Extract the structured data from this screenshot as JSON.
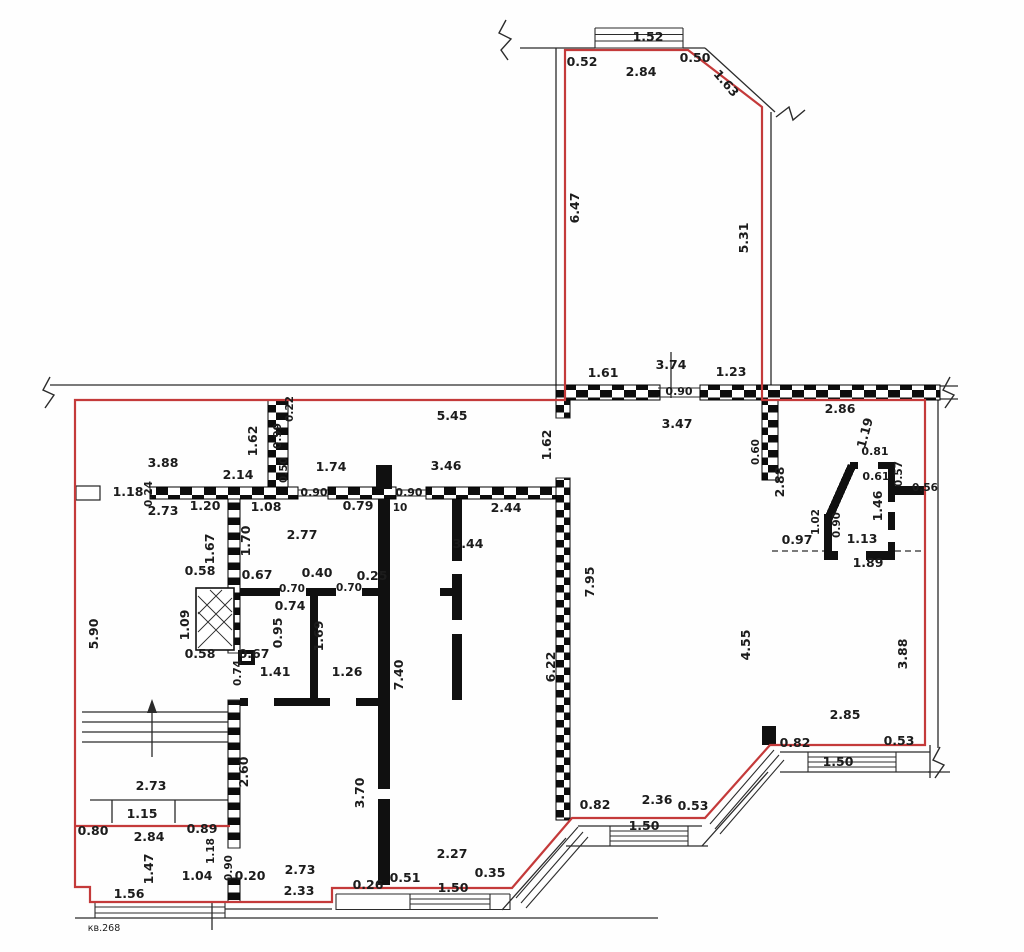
{
  "apartment_label": "кв.268",
  "colors": {
    "boundary": "#c43a3a",
    "wall": "#101010",
    "line": "#2b2b2b"
  },
  "plan": {
    "type": "floor-plan",
    "units": "meters"
  },
  "labels": [
    {
      "t": "1.52",
      "x": 648,
      "y": 41
    },
    {
      "t": "0.52",
      "x": 582,
      "y": 66
    },
    {
      "t": "2.84",
      "x": 641,
      "y": 76
    },
    {
      "t": "0.50",
      "x": 695,
      "y": 62
    },
    {
      "t": "1.63",
      "x": 723,
      "y": 86,
      "r": 49
    },
    {
      "t": "6.47",
      "x": 579,
      "y": 208,
      "r": -90
    },
    {
      "t": "5.31",
      "x": 748,
      "y": 238,
      "r": -90
    },
    {
      "t": "1.61",
      "x": 603,
      "y": 377
    },
    {
      "t": "3.74",
      "x": 671,
      "y": 369
    },
    {
      "t": "1.23",
      "x": 731,
      "y": 376
    },
    {
      "t": "0.90",
      "x": 679,
      "y": 395,
      "s": 11
    },
    {
      "t": "0.22",
      "x": 293,
      "y": 409,
      "r": -90,
      "s": 10.5
    },
    {
      "t": "0.99",
      "x": 281,
      "y": 436,
      "r": -90,
      "s": 10.5
    },
    {
      "t": "1.62",
      "x": 257,
      "y": 441,
      "r": -90
    },
    {
      "t": "0.50",
      "x": 287,
      "y": 470,
      "r": -90,
      "s": 10.5
    },
    {
      "t": "3.88",
      "x": 163,
      "y": 467
    },
    {
      "t": "2.14",
      "x": 238,
      "y": 479
    },
    {
      "t": "1.74",
      "x": 331,
      "y": 471
    },
    {
      "t": "5.45",
      "x": 452,
      "y": 420
    },
    {
      "t": "3.46",
      "x": 446,
      "y": 470
    },
    {
      "t": "1.62",
      "x": 551,
      "y": 445,
      "r": -90
    },
    {
      "t": "1.18",
      "x": 128,
      "y": 496
    },
    {
      "t": "0.24",
      "x": 152,
      "y": 494,
      "r": -90,
      "s": 10.5
    },
    {
      "t": "2.73",
      "x": 163,
      "y": 515
    },
    {
      "t": "1.20",
      "x": 205,
      "y": 510
    },
    {
      "t": "1.08",
      "x": 266,
      "y": 511
    },
    {
      "t": "0.90",
      "x": 314,
      "y": 496,
      "s": 11
    },
    {
      "t": "0.79",
      "x": 358,
      "y": 510
    },
    {
      "t": "0.90",
      "x": 409,
      "y": 496,
      "s": 11
    },
    {
      "t": "10",
      "x": 400,
      "y": 511,
      "s": 10.5
    },
    {
      "t": "2.44",
      "x": 506,
      "y": 512
    },
    {
      "t": "3.47",
      "x": 677,
      "y": 428
    },
    {
      "t": "2.86",
      "x": 840,
      "y": 413
    },
    {
      "t": "0.60",
      "x": 759,
      "y": 452,
      "r": -90,
      "s": 10.5
    },
    {
      "t": "2.88",
      "x": 784,
      "y": 482,
      "r": -90
    },
    {
      "t": "1.19",
      "x": 869,
      "y": 434,
      "r": -75
    },
    {
      "t": "0.81",
      "x": 875,
      "y": 455,
      "s": 11
    },
    {
      "t": "0.61",
      "x": 876,
      "y": 480,
      "s": 11
    },
    {
      "t": "0.57",
      "x": 902,
      "y": 474,
      "r": -90,
      "s": 10.5
    },
    {
      "t": "0.56",
      "x": 925,
      "y": 491,
      "s": 10.5
    },
    {
      "t": "1.46",
      "x": 882,
      "y": 506,
      "r": -90
    },
    {
      "t": "1.02",
      "x": 819,
      "y": 522,
      "r": -90,
      "s": 10.5
    },
    {
      "t": "0.90",
      "x": 840,
      "y": 525,
      "r": -90,
      "s": 10.5
    },
    {
      "t": "1.13",
      "x": 862,
      "y": 543
    },
    {
      "t": "0.97",
      "x": 797,
      "y": 544
    },
    {
      "t": "1.89",
      "x": 868,
      "y": 567
    },
    {
      "t": "1.70",
      "x": 250,
      "y": 541,
      "r": -90
    },
    {
      "t": "2.77",
      "x": 302,
      "y": 539
    },
    {
      "t": "1.67",
      "x": 214,
      "y": 549,
      "r": -90
    },
    {
      "t": "0.58",
      "x": 200,
      "y": 575
    },
    {
      "t": "0.67",
      "x": 257,
      "y": 579
    },
    {
      "t": "0.40",
      "x": 317,
      "y": 577
    },
    {
      "t": "0.25",
      "x": 372,
      "y": 580
    },
    {
      "t": "0.70",
      "x": 292,
      "y": 592,
      "s": 10.5
    },
    {
      "t": "0.70",
      "x": 349,
      "y": 591,
      "s": 10.5
    },
    {
      "t": "0.74",
      "x": 290,
      "y": 610
    },
    {
      "t": "0.95",
      "x": 282,
      "y": 633,
      "r": -90
    },
    {
      "t": "1.09",
      "x": 189,
      "y": 625,
      "r": -90
    },
    {
      "t": "0.58",
      "x": 200,
      "y": 658
    },
    {
      "t": "0.67",
      "x": 254,
      "y": 658
    },
    {
      "t": "0.74",
      "x": 241,
      "y": 673,
      "r": -90,
      "s": 10.5
    },
    {
      "t": "1.41",
      "x": 275,
      "y": 676
    },
    {
      "t": "1.26",
      "x": 347,
      "y": 676
    },
    {
      "t": "1.69",
      "x": 323,
      "y": 636,
      "r": -90
    },
    {
      "t": "5.90",
      "x": 98,
      "y": 634,
      "r": -90
    },
    {
      "t": "3.44",
      "x": 468,
      "y": 548
    },
    {
      "t": "7.95",
      "x": 594,
      "y": 582,
      "r": -90
    },
    {
      "t": "6.22",
      "x": 555,
      "y": 667,
      "r": -90
    },
    {
      "t": "7.40",
      "x": 403,
      "y": 675,
      "r": -90
    },
    {
      "t": "4.55",
      "x": 750,
      "y": 645,
      "r": -90
    },
    {
      "t": "3.88",
      "x": 907,
      "y": 654,
      "r": -90
    },
    {
      "t": "2.85",
      "x": 845,
      "y": 719
    },
    {
      "t": "0.82",
      "x": 795,
      "y": 747
    },
    {
      "t": "0.53",
      "x": 899,
      "y": 745
    },
    {
      "t": "1.50",
      "x": 838,
      "y": 766
    },
    {
      "t": "2.60",
      "x": 248,
      "y": 772,
      "r": -90
    },
    {
      "t": "3.70",
      "x": 364,
      "y": 793,
      "r": -90
    },
    {
      "t": "2.73",
      "x": 151,
      "y": 790
    },
    {
      "t": "1.15",
      "x": 142,
      "y": 818
    },
    {
      "t": "0.80",
      "x": 93,
      "y": 835
    },
    {
      "t": "2.84",
      "x": 149,
      "y": 841
    },
    {
      "t": "0.89",
      "x": 202,
      "y": 833
    },
    {
      "t": "1.18",
      "x": 214,
      "y": 851,
      "r": -90,
      "s": 10.5
    },
    {
      "t": "1.47",
      "x": 153,
      "y": 869,
      "r": -90
    },
    {
      "t": "0.90",
      "x": 232,
      "y": 868,
      "r": -90,
      "s": 10.5
    },
    {
      "t": "1.04",
      "x": 197,
      "y": 880
    },
    {
      "t": "0.20",
      "x": 250,
      "y": 880
    },
    {
      "t": "2.73",
      "x": 300,
      "y": 874
    },
    {
      "t": "1.56",
      "x": 129,
      "y": 898
    },
    {
      "t": "2.33",
      "x": 299,
      "y": 895
    },
    {
      "t": "0.26",
      "x": 368,
      "y": 889
    },
    {
      "t": "0.51",
      "x": 405,
      "y": 882
    },
    {
      "t": "2.27",
      "x": 452,
      "y": 858
    },
    {
      "t": "0.35",
      "x": 490,
      "y": 877
    },
    {
      "t": "1.50",
      "x": 453,
      "y": 892
    },
    {
      "t": "0.82",
      "x": 595,
      "y": 809
    },
    {
      "t": "2.36",
      "x": 657,
      "y": 804
    },
    {
      "t": "0.53",
      "x": 693,
      "y": 810
    },
    {
      "t": "1.50",
      "x": 644,
      "y": 830
    }
  ]
}
